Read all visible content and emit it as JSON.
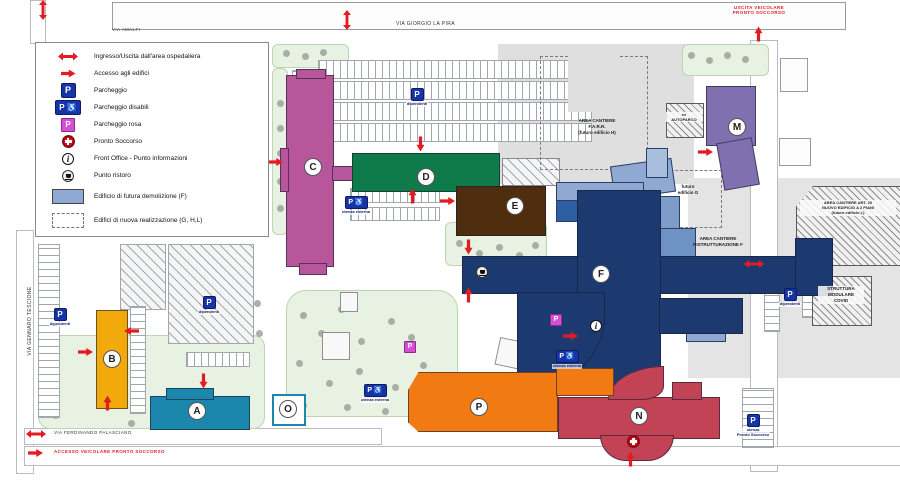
{
  "legend": {
    "items": [
      {
        "id": "ingresso-uscita",
        "label": "Ingresso/Uscita dall'area ospedaliera"
      },
      {
        "id": "accesso-edifici",
        "label": "Accesso agli edifici"
      },
      {
        "id": "parcheggio",
        "label": "Parcheggio"
      },
      {
        "id": "parcheggio-disabili",
        "label": "Parcheggio disabili"
      },
      {
        "id": "parcheggio-rosa",
        "label": "Parcheggio rosa"
      },
      {
        "id": "pronto-soccorso",
        "label": "Pronto Soccorso"
      },
      {
        "id": "front-office",
        "label": "Front Office - Punto informazioni"
      },
      {
        "id": "punto-ristoro",
        "label": "Punto ristoro"
      },
      {
        "id": "futura-demolizione",
        "label": "Edificio di futura demolizione (F)"
      },
      {
        "id": "nuova-realizzazione",
        "label": "Edifici di nuova realizzazione (G, H,L)"
      }
    ]
  },
  "streets": {
    "via_amalfi": "VIA AMALFI",
    "via_giorgio_la_pira": "VIA GIORGIO LA PIRA",
    "via_gennaro_tescione": "VIA GENNARO TESCIONE",
    "via_ferdinando_palasciano": "VIA FERDINANDO PALASCIANO",
    "accesso_veicolare_ps": "ACCESSO VEICOLARE PRONTO SOCCORSO",
    "uscita_veicolare_ps": "USCITA VEICOLARE\nPRONTO SOCCORSO"
  },
  "buildings": {
    "a": {
      "label": "A",
      "color": "#1b87ad"
    },
    "b": {
      "label": "B",
      "color": "#f2a90c"
    },
    "c": {
      "label": "C",
      "color": "#b8569b"
    },
    "d": {
      "label": "D",
      "color": "#0f7a4a"
    },
    "e": {
      "label": "E",
      "color": "#4f2e10"
    },
    "f": {
      "label": "F",
      "color": "#1c3a70"
    },
    "m": {
      "label": "M",
      "color": "#8070b0"
    },
    "n": {
      "label": "N",
      "color": "#c24356"
    },
    "o": {
      "label": "O",
      "color": "#ffffff"
    },
    "p": {
      "label": "P",
      "color": "#f27a12"
    }
  },
  "areas": {
    "cantiere_farr": "AREA CANTIERE\nF.A.R.R.\n(futuro edificio H)",
    "autoparco": "ex\nAUTOPARCO",
    "futuro_g": "futuro\nedificio G",
    "ristrutturazione_f": "AREA CANTIERE\nRISTRUTTURAZIONE F",
    "art20": "AREA CANTIERE ART. 20\nNUOVO EDIFICIO A 2 PIANI\n(futuro edificio L)",
    "covid": "STRUTTURA\nMODULARE\nCOVID"
  },
  "parking": {
    "dipendenti": "dipendenti",
    "utenza_esterna": "utenza esterna",
    "utenza_pronto_soccorso": "utenza\nPronto Soccorso"
  },
  "icons": {
    "parking_glyph": "P",
    "wheelchair_glyph": "♿",
    "info_glyph": "i"
  }
}
